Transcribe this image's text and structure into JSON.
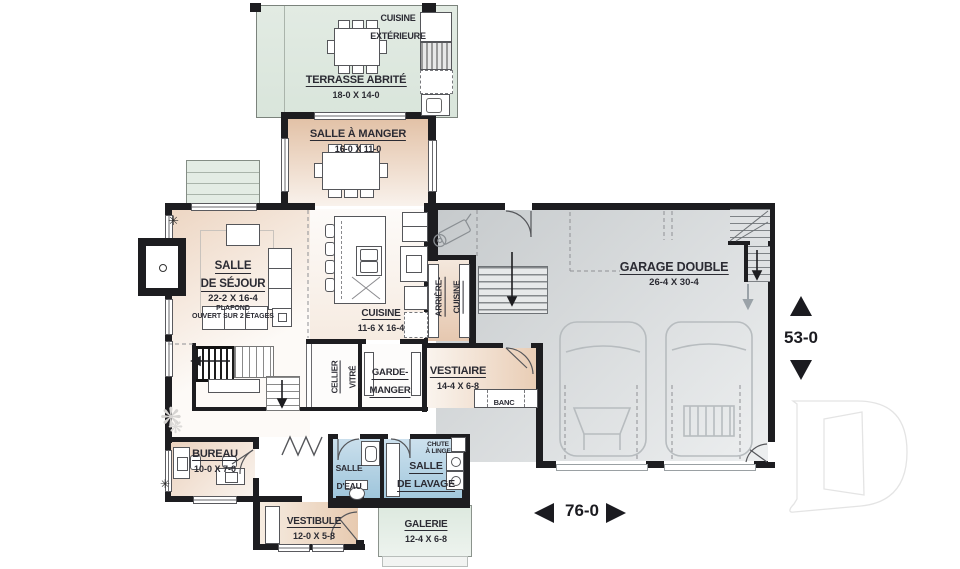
{
  "rooms": {
    "cuisine_exterieure": {
      "line1": "CUISINE",
      "line2": "EXTÉRIEURE"
    },
    "terrasse": {
      "name": "TERRASSE ABRITÉ",
      "dims": "18-0 X 14-0"
    },
    "salle_a_manger": {
      "name": "SALLE À MANGER",
      "dims": "16-0 X 11-0"
    },
    "salle_de_sejour": {
      "line1": "SALLE",
      "line2": "DE SÉJOUR",
      "dims": "22-2 X 16-4",
      "note1": "PLAFOND",
      "note2": "OUVERT SUR 2 ÉTAGES"
    },
    "cuisine": {
      "name": "CUISINE",
      "dims": "11-6 X 16-4"
    },
    "arriere_cuisine": {
      "line1": "ARRIÈRE-",
      "line2": "CUISINE"
    },
    "garage": {
      "name": "GARAGE DOUBLE",
      "dims": "26-4 X 30-4"
    },
    "cellier": {
      "line1": "CELLIER",
      "line2": "VITRÉ"
    },
    "garde_manger": {
      "line1": "GARDE-",
      "line2": "MANGER"
    },
    "vestiaire": {
      "name": "VESTIAIRE",
      "dims": "14-4 X 6-8"
    },
    "banc": {
      "name": "BANC"
    },
    "bureau": {
      "name": "BUREAU",
      "dims": "10-0 X 7-0"
    },
    "salle_eau": {
      "line1": "SALLE",
      "line2": "D'EAU"
    },
    "salle_lavage": {
      "line1": "SALLE",
      "line2": "DE LAVAGE"
    },
    "chute_linge": {
      "line1": "CHUTE",
      "line2": "À LINGE"
    },
    "vestibule": {
      "name": "VESTIBULE",
      "dims": "12-0 X 5-8"
    },
    "galerie": {
      "name": "GALERIE",
      "dims": "12-4 X 6-8"
    }
  },
  "overall_dimensions": {
    "width": "76-0",
    "depth": "53-0"
  },
  "colors": {
    "wall": "#1d1d20",
    "label_ink": "#2b2b33",
    "terrace_green": "#dfe9e0",
    "room_beige": "#e6c7ae",
    "garage_gray": "#c9cdcf",
    "wet_room_blue": "#a3c8dd",
    "porch_green": "#dce8de",
    "watermark_gray": "#e4e4e4"
  }
}
